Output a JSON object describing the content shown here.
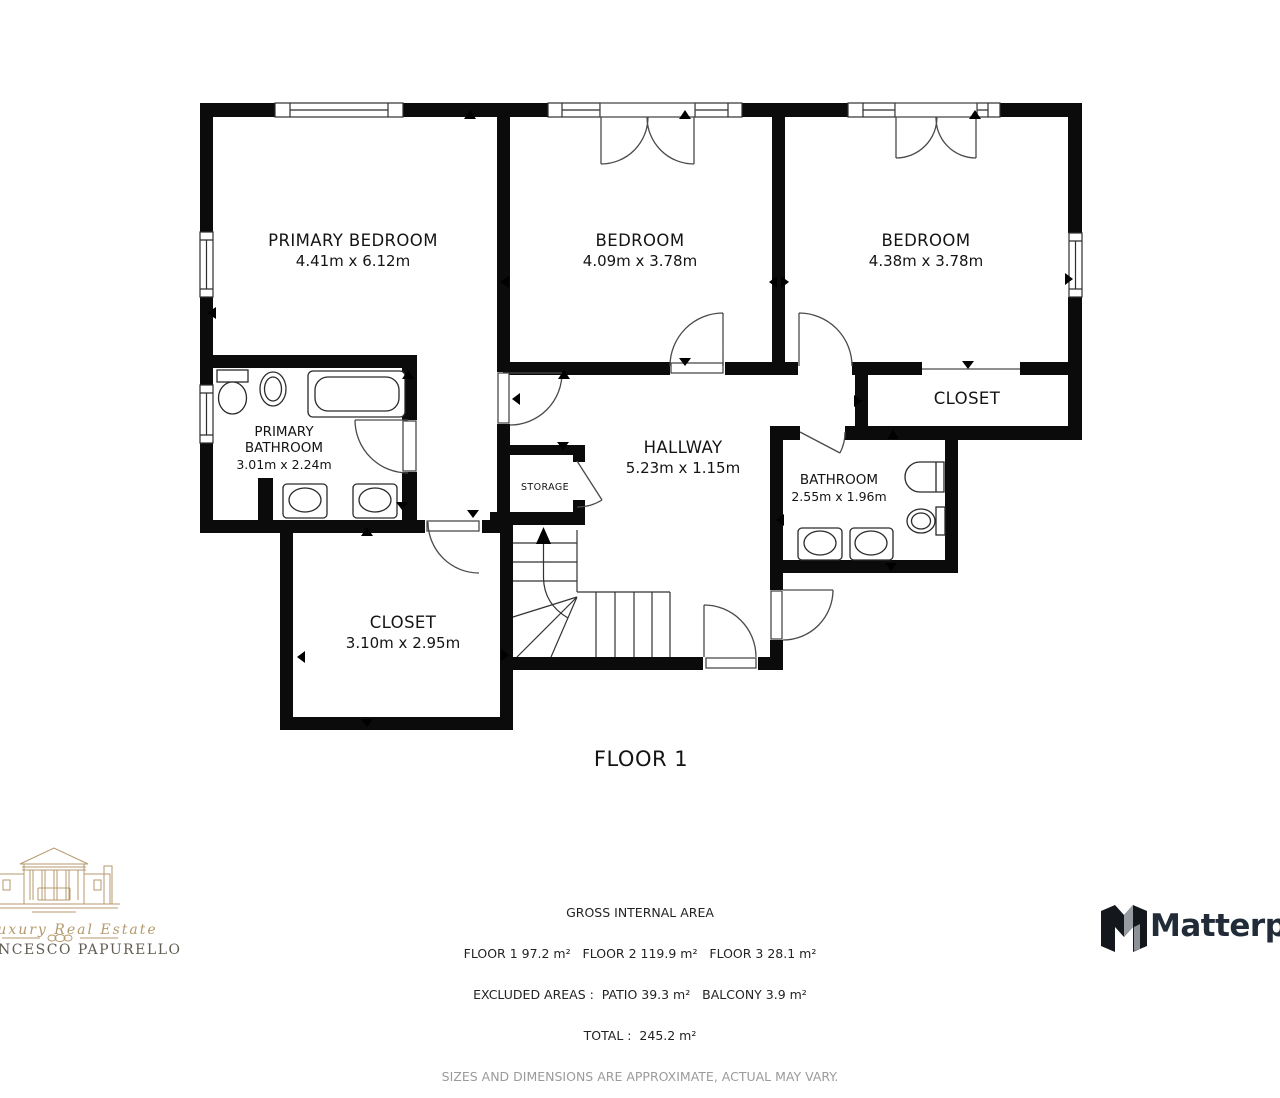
{
  "plan": {
    "floor_title": "FLOOR 1",
    "rooms": {
      "primary_bedroom": {
        "name": "PRIMARY BEDROOM",
        "dims": "4.41m x 6.12m"
      },
      "bedroom_center": {
        "name": "BEDROOM",
        "dims": "4.09m x 3.78m"
      },
      "bedroom_right": {
        "name": "BEDROOM",
        "dims": "4.38m x 3.78m"
      },
      "closet_right": {
        "name": "CLOSET"
      },
      "primary_bathroom": {
        "name_line1": "PRIMARY",
        "name_line2": "BATHROOM",
        "dims": "3.01m x 2.24m"
      },
      "hallway": {
        "name": "HALLWAY",
        "dims": "5.23m x 1.15m"
      },
      "bathroom": {
        "name": "BATHROOM",
        "dims": "2.55m x 1.96m"
      },
      "storage": {
        "name": "STORAGE"
      },
      "closet_lower": {
        "name": "CLOSET",
        "dims": "3.10m x 2.95m"
      }
    }
  },
  "footer": {
    "title": "GROSS INTERNAL AREA",
    "areas_line": "FLOOR 1 97.2 m²   FLOOR 2 119.9 m²   FLOOR 3 28.1 m²",
    "excluded_line": "EXCLUDED AREAS :  PATIO 39.3 m²   BALCONY 3.9 m²",
    "total_line": "TOTAL :  245.2 m²",
    "disclaimer": "SIZES AND DIMENSIONS ARE APPROXIMATE, ACTUAL MAY VARY."
  },
  "branding": {
    "agent_script": "Luxury Real Estate",
    "agent_name": "NCESCO PAPURELLO",
    "provider_name": "Matterpo",
    "gold_color": "#b49a6c",
    "provider_color": "#222c39",
    "wall_color": "#0b0b0b"
  }
}
